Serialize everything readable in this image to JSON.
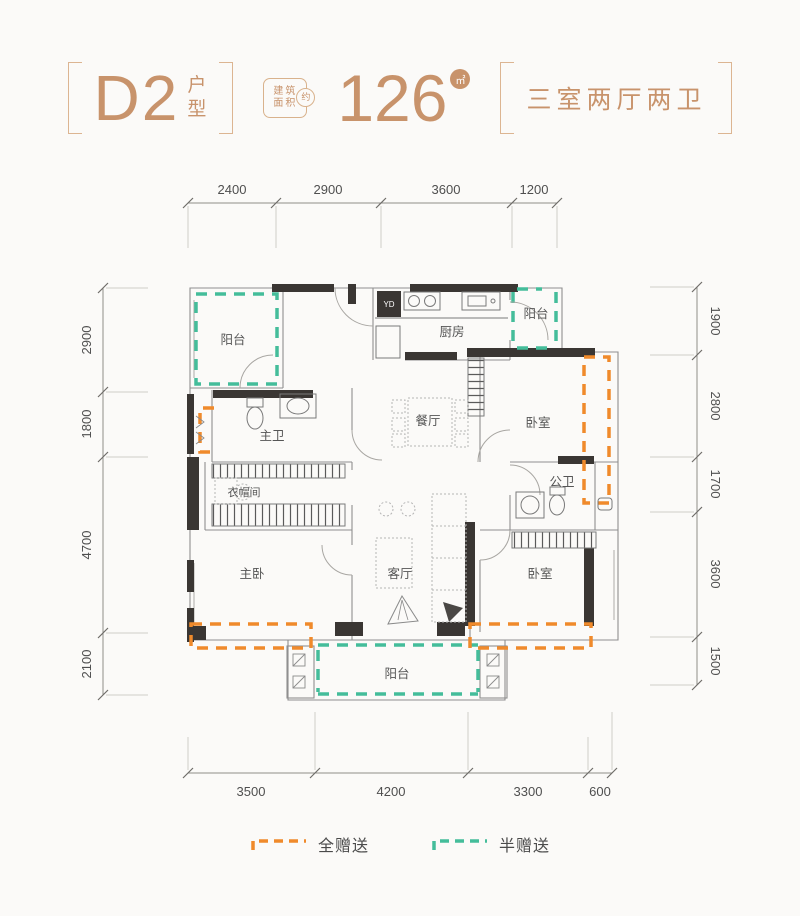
{
  "header": {
    "plan_name": "D2",
    "plan_suffix_1": "户",
    "plan_suffix_2": "型",
    "seal_line1": "建筑",
    "seal_line2": "面积",
    "seal_circle": "约",
    "area_value": "126",
    "area_unit": "㎡",
    "layout_desc": "三室两厅两卫"
  },
  "dimensions": {
    "top": [
      "2400",
      "2900",
      "3600",
      "1200"
    ],
    "bottom": [
      "3500",
      "4200",
      "3300",
      "600"
    ],
    "left": [
      "2900",
      "1800",
      "4700",
      "2100"
    ],
    "right": [
      "1900",
      "2800",
      "1700",
      "3600",
      "1500"
    ]
  },
  "rooms": {
    "balcony_top_left": "阳台",
    "master_bath": "主卫",
    "closet": "衣帽间",
    "master_bedroom": "主卧",
    "kitchen": "厨房",
    "balcony_top_right": "阳台",
    "dining": "餐厅",
    "bedroom_right_top": "卧室",
    "common_bath": "公卫",
    "living": "客厅",
    "bedroom_right_bottom": "卧室",
    "balcony_bottom": "阳台"
  },
  "fixtures": {
    "fridge": "YD"
  },
  "legend": {
    "full_gift": "全赠送",
    "half_gift": "半赠送"
  },
  "colors": {
    "accent": "#C8936B",
    "bracket": "#DCB592",
    "full_gift": "#F08A2B",
    "half_gift": "#44BD9A",
    "wall": "#3A3633"
  }
}
